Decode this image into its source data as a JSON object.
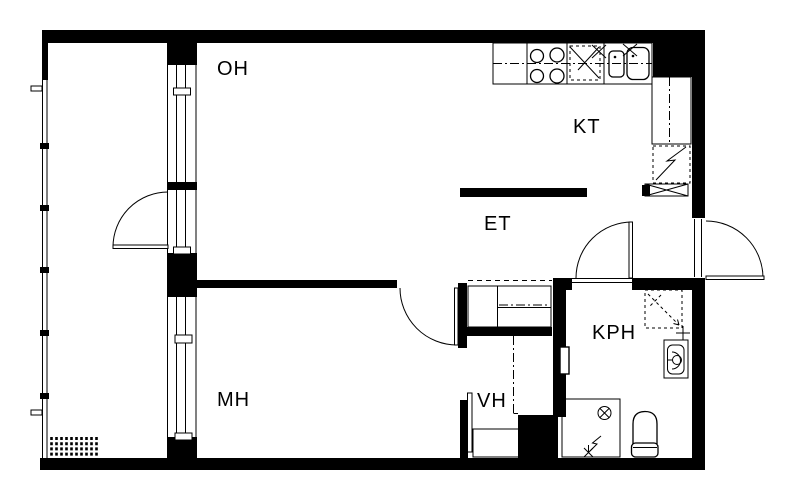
{
  "rooms": {
    "oh": {
      "label": "OH"
    },
    "kt": {
      "label": "KT"
    },
    "et": {
      "label": "ET"
    },
    "mh": {
      "label": "MH"
    },
    "vh": {
      "label": "VH"
    },
    "kph": {
      "label": "KPH"
    }
  },
  "colors": {
    "wall": "#000000",
    "line": "#000000",
    "background": "#ffffff"
  },
  "fixtures": [
    "stove-icon",
    "sink-icon",
    "dishwasher-icon",
    "tall-cabinet-icon",
    "fridge-icon",
    "wardrobe-icon",
    "shower-icon",
    "washbasin-icon",
    "toilet-icon",
    "floor-drain-icon",
    "hand-shower-icon",
    "washing-machine-space-icon",
    "balcony-rail",
    "balcony-hatch",
    "door-swing"
  ]
}
